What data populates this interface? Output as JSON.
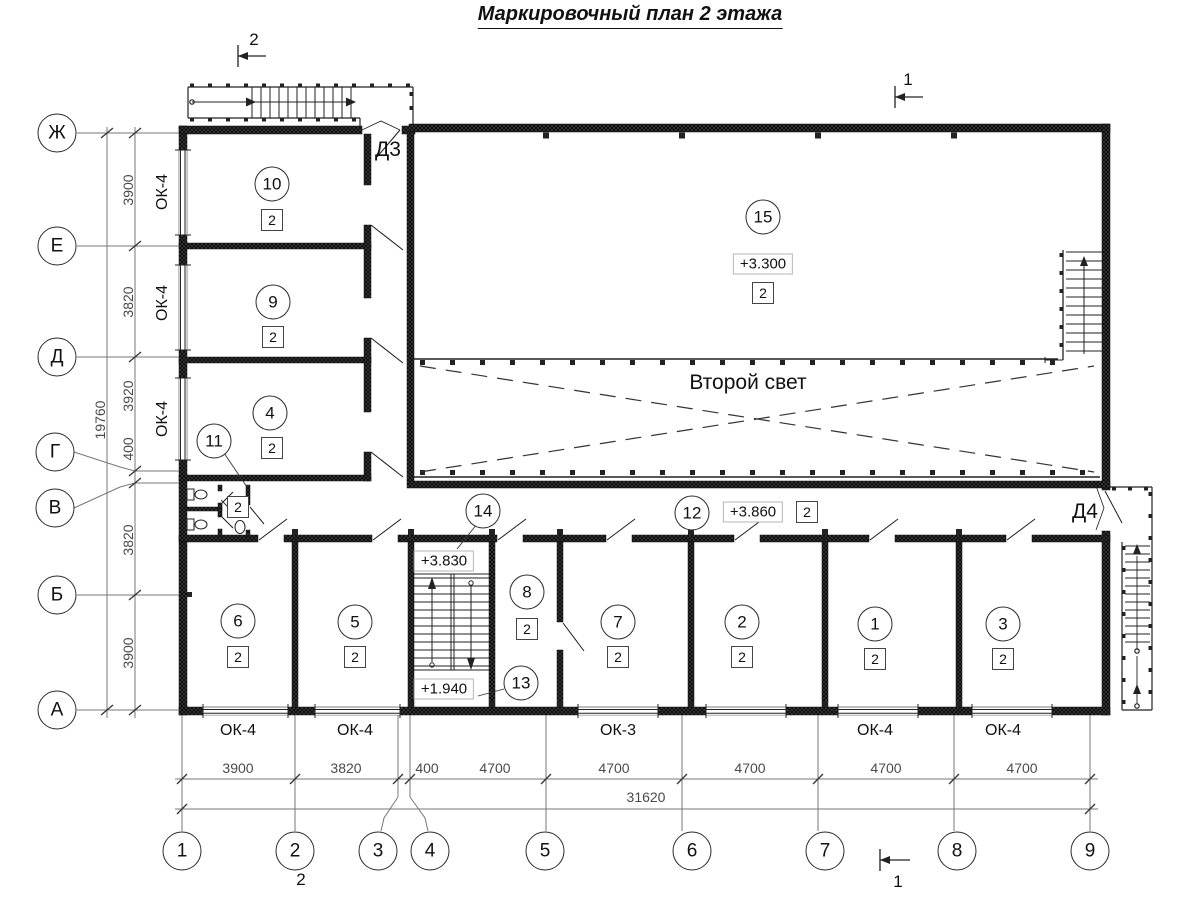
{
  "title": "Маркировочный план 2 этажа",
  "axes": {
    "rows": [
      "Ж",
      "Е",
      "Д",
      "Г",
      "В",
      "Б",
      "А"
    ],
    "cols": [
      "1",
      "2",
      "3",
      "4",
      "5",
      "6",
      "7",
      "8",
      "9"
    ]
  },
  "dimensions": {
    "left": [
      "3900",
      "3820",
      "3920",
      "400",
      "3820",
      "3900"
    ],
    "left_total": "19760",
    "bottom": [
      "3900",
      "3820",
      "400",
      "4700",
      "4700",
      "4700",
      "4700",
      "4700"
    ],
    "bottom_total": "31620"
  },
  "windows": {
    "left": [
      "ОК-4",
      "ОК-4",
      "ОК-4"
    ],
    "bottom": [
      "ОК-4",
      "ОК-4",
      "ОК-3",
      "ОК-4",
      "ОК-4"
    ]
  },
  "doors": {
    "d3": "Д3",
    "d4": "Д4"
  },
  "section_marks": {
    "s1": "1",
    "s2": "2"
  },
  "second_light": "Второй свет",
  "elevations": {
    "hall": "+3.300",
    "corridor": "+3.860",
    "stair_upper": "+3.830",
    "stair_lower": "+1.940"
  },
  "rooms": {
    "r1": {
      "number": "1",
      "mark": "2"
    },
    "r2": {
      "number": "2",
      "mark": "2"
    },
    "r3": {
      "number": "3",
      "mark": "2"
    },
    "r4": {
      "number": "4",
      "mark": "2"
    },
    "r5": {
      "number": "5",
      "mark": "2"
    },
    "r6": {
      "number": "6",
      "mark": "2"
    },
    "r7": {
      "number": "7",
      "mark": "2"
    },
    "r8": {
      "number": "8",
      "mark": "2"
    },
    "r9": {
      "number": "9",
      "mark": "2"
    },
    "r10": {
      "number": "10",
      "mark": "2"
    },
    "r11": {
      "number": "11"
    },
    "r12": {
      "number": "12"
    },
    "r13": {
      "number": "13"
    },
    "r14": {
      "number": "14"
    },
    "r15": {
      "number": "15",
      "mark": "2"
    },
    "wc": {
      "mark": "2"
    },
    "corridor": {
      "mark": "2"
    }
  }
}
